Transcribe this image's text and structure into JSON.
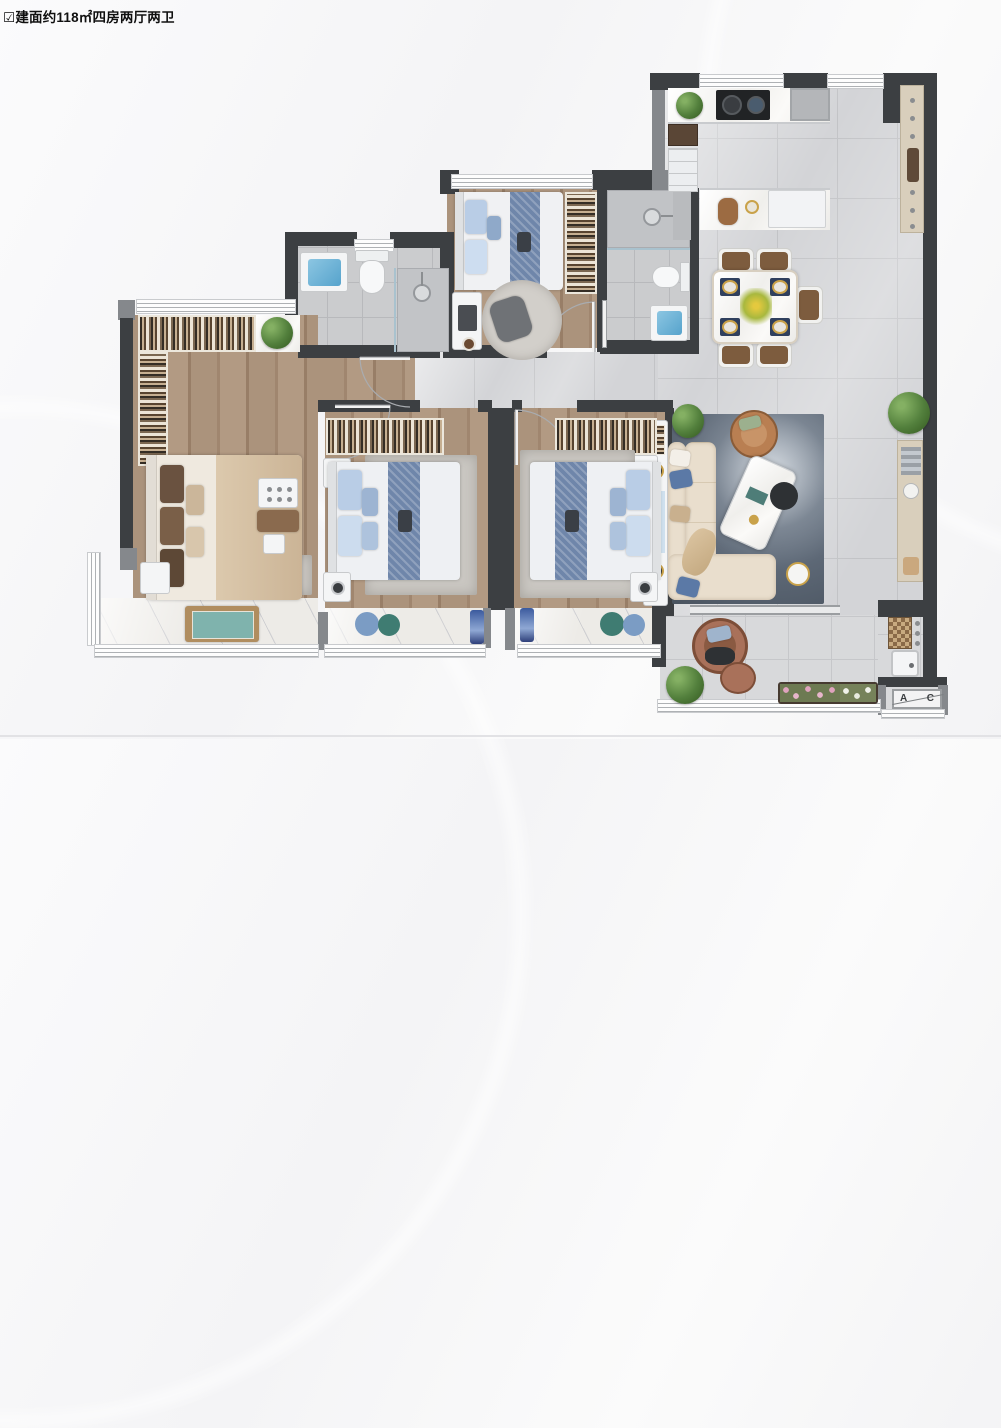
{
  "header": {
    "icon": "☑",
    "title": "建面约118㎡四房两厅两卫"
  },
  "ac_unit": {
    "label_a": "A",
    "label_c": "C"
  },
  "colors": {
    "wall-dark": "#3c3f42",
    "wall-gray": "#85888c",
    "floor-marble": "#d3d4d7",
    "floor-bath": "#cbccce",
    "floor-wood": "#a8907a",
    "floor-balcony": "#edebe7",
    "rug-living": "#5d6876",
    "rug-bedroom": "#cac7c2",
    "bed-runner": "#6f86aa",
    "pillow-blue": "#b9cde6",
    "master-beige": "#d6c3a8",
    "sofa-cream": "#e9decd",
    "armchair-tan": "#b97f52",
    "dining-seat": "#7d5c3e",
    "water-blue": "#6cb4d8",
    "plant-green": "#4e7d3e",
    "pouf-teal": "#3f7c72",
    "pouf-blue": "#7b9cc4",
    "flower-pink": "#dfa3bd",
    "stove-black": "#212325",
    "accent-gold": "#c9a24a"
  }
}
